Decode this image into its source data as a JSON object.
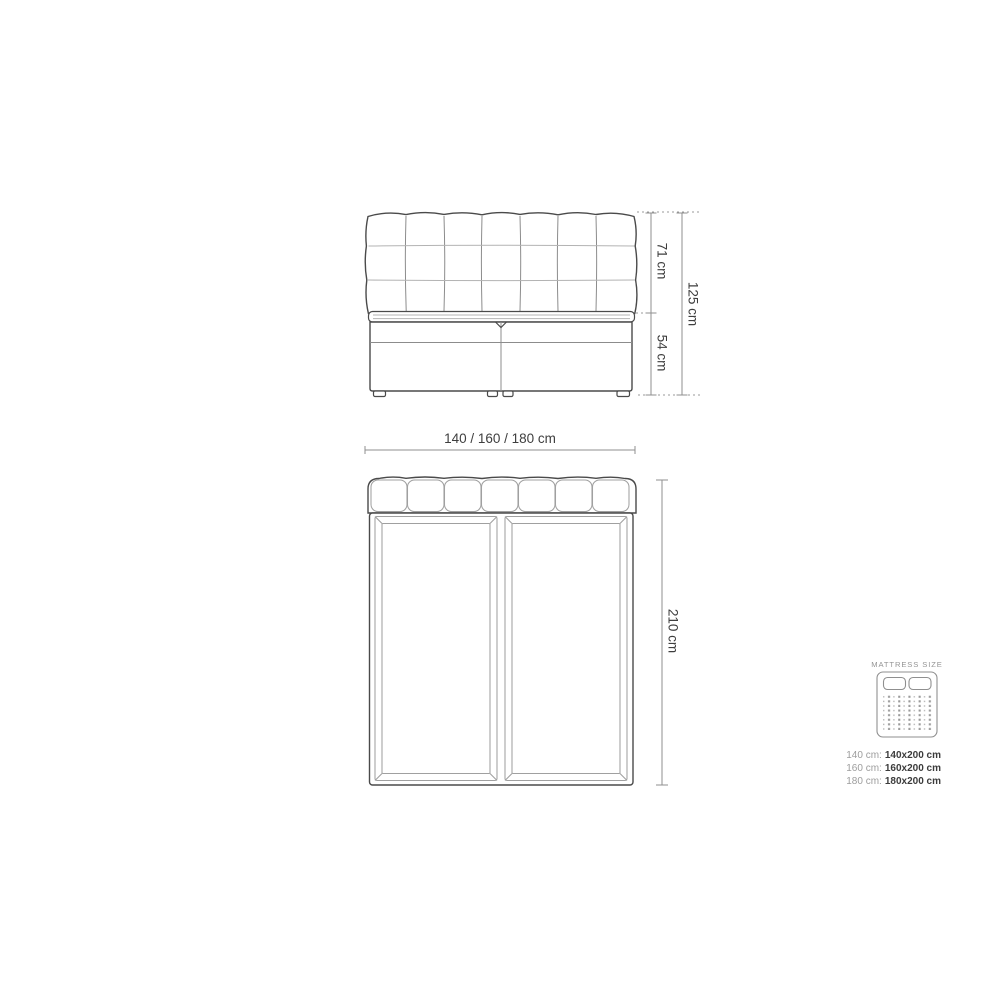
{
  "diagram": {
    "type": "bed-dimensions-technical-drawing",
    "front_view": {
      "name": "bed front elevation",
      "headboard_columns": 7,
      "headboard_rows": 3,
      "labels": {
        "headboard_height": "71 cm",
        "base_height": "54 cm",
        "total_height": "125 cm"
      }
    },
    "top_view": {
      "name": "bed top plan",
      "mattress_halves": 2,
      "labels": {
        "width": "140 / 160 / 180 cm",
        "length": "210 cm"
      }
    },
    "legend": {
      "title": "MATTRESS SIZE",
      "icon": "mattress-icon",
      "rows": [
        {
          "prefix": "140 cm:",
          "value": "140x200 cm"
        },
        {
          "prefix": "160 cm:",
          "value": "160x200 cm"
        },
        {
          "prefix": "180 cm:",
          "value": "180x200 cm"
        }
      ]
    },
    "colors": {
      "background": "#ffffff",
      "outline": "#4a4a4a",
      "inner_line": "#8c8c8c",
      "light_line": "#b3b3b3",
      "dimension_line": "#8f8f8f",
      "dimension_text": "#3e3e3e",
      "legend_muted": "#9d9d9d",
      "legend_value": "#3c3c3c"
    }
  }
}
